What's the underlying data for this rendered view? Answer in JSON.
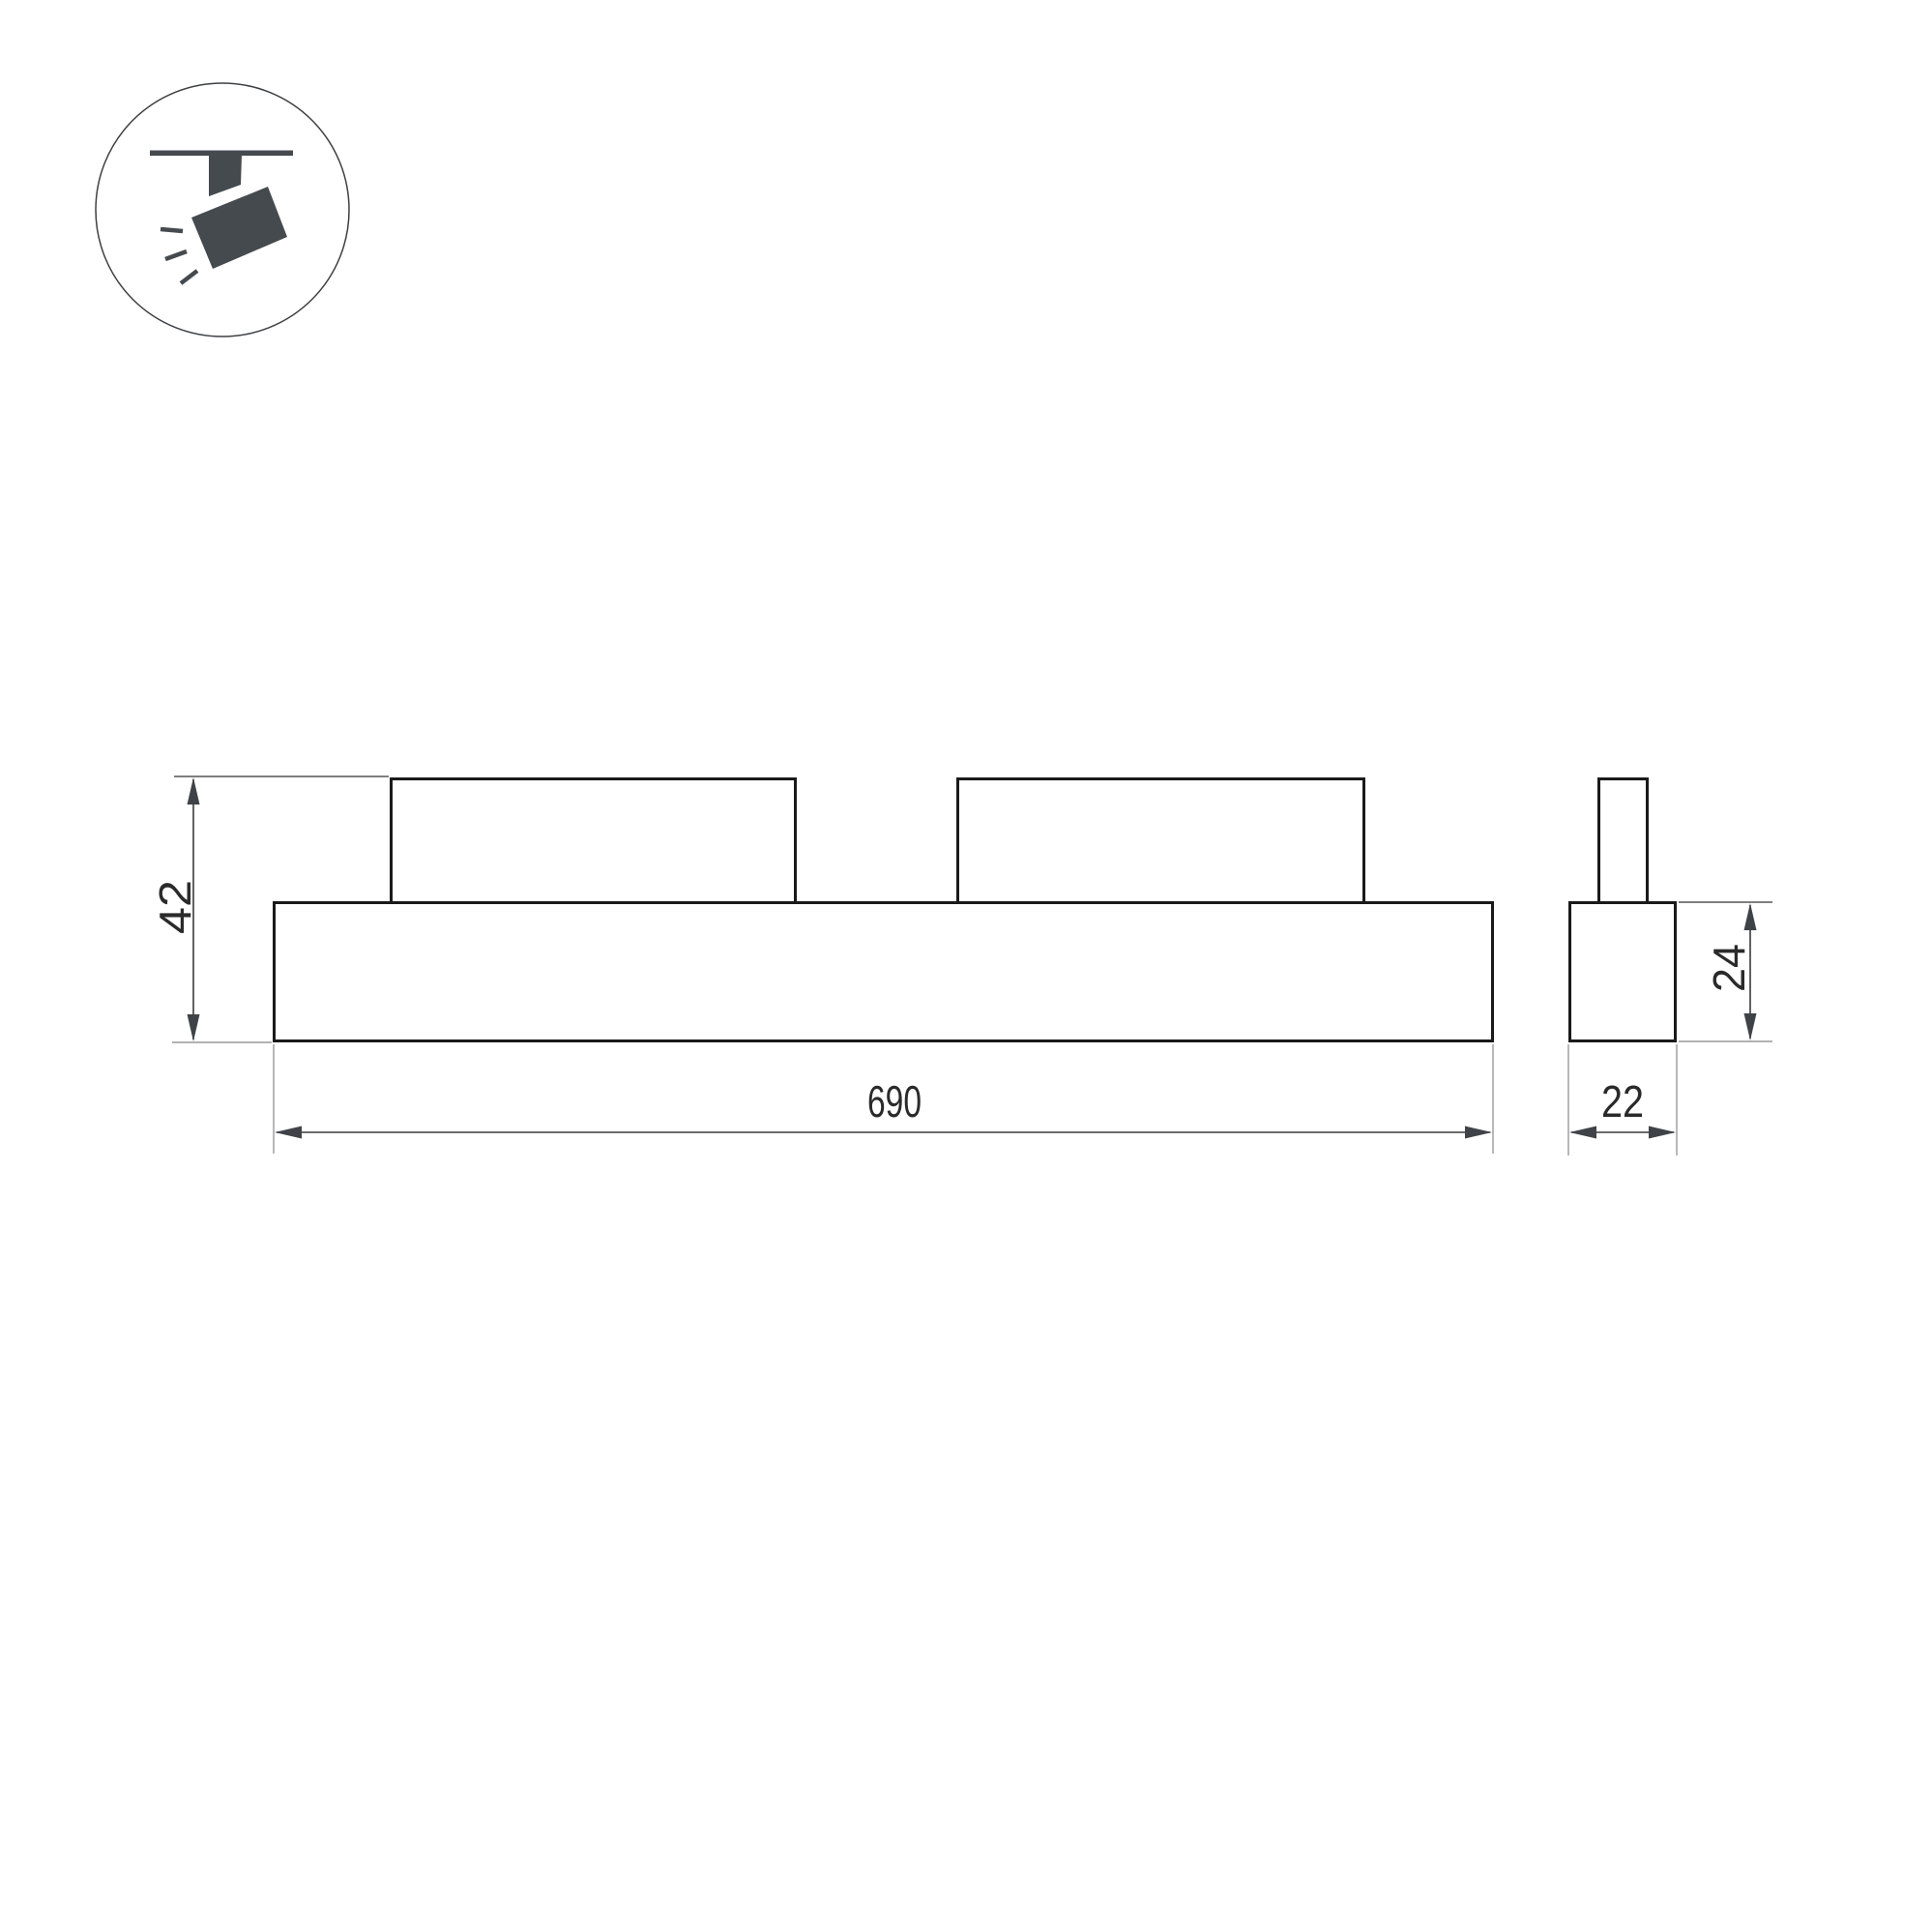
{
  "icon": {
    "name": "track-spotlight-icon"
  },
  "dimensions": {
    "front_total_height": "42",
    "front_length": "690",
    "side_body_height": "24",
    "side_width": "22"
  },
  "colors": {
    "outline": "#1a1a1a",
    "dimension_lines": "#3a3a3a",
    "extension_lines": "#999999",
    "icon_fill": "#454a4f",
    "label_text": "#2a2a2a",
    "background": "#ffffff"
  }
}
